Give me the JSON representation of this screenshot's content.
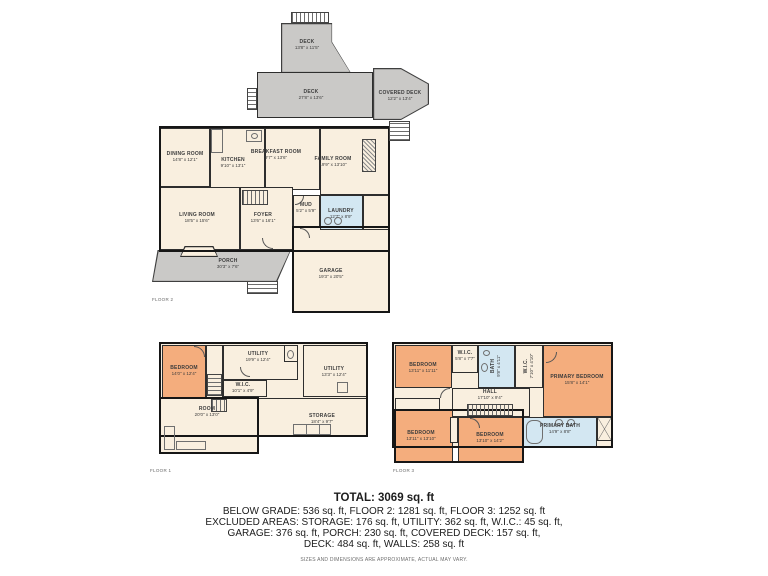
{
  "colors": {
    "room_cream": "#f9efdf",
    "bedroom_orange": "#f4ad7d",
    "bath_blue": "#d3e7f2",
    "deck_gray": "#cac9c7",
    "wall": "#161616"
  },
  "floor2": {
    "label": "FLOOR 2",
    "rooms": {
      "deck_upper": {
        "name": "DECK",
        "dims": "13'8\" x 11'5\""
      },
      "deck_main": {
        "name": "DECK",
        "dims": "27'8\" x 13'6\""
      },
      "covered_deck": {
        "name": "COVERED DECK",
        "dims": "12'2\" x 13'4\""
      },
      "dining": {
        "name": "DINING ROOM",
        "dims": "14'8\" x 12'1\""
      },
      "kitchen": {
        "name": "KITCHEN",
        "dims": "9'10\" x 13'1\""
      },
      "breakfast": {
        "name": "BREAKFAST ROOM",
        "dims": "9'7\" x 13'6\""
      },
      "family": {
        "name": "FAMILY ROOM",
        "dims": "19'9\" x 13'10\""
      },
      "living": {
        "name": "LIVING ROOM",
        "dims": "18'5\" x 15'6\""
      },
      "foyer": {
        "name": "FOYER",
        "dims": "13'6\" x 16'1\""
      },
      "mud": {
        "name": "MUD",
        "dims": "5'2\" x 5'9\""
      },
      "laundry": {
        "name": "LAUNDRY",
        "dims": "12'7\" x 8'9\""
      },
      "porch": {
        "name": "PORCH",
        "dims": "30'3\" x 7'6\""
      },
      "garage": {
        "name": "GARAGE",
        "dims": "19'3\" x 20'5\""
      }
    }
  },
  "floor1": {
    "label": "FLOOR 1",
    "rooms": {
      "bedroom": {
        "name": "BEDROOM",
        "dims": "14'0\" x 12'4\""
      },
      "utility_top": {
        "name": "UTILITY",
        "dims": "19'9\" x 12'4\""
      },
      "utility_right": {
        "name": "UTILITY",
        "dims": "13'3\" x 12'4\""
      },
      "wic": {
        "name": "W.I.C.",
        "dims": "10'1\" x 4'9\""
      },
      "room": {
        "name": "ROOM",
        "dims": "20'0\" x 13'0\""
      },
      "storage": {
        "name": "STORAGE",
        "dims": "18'4\" x 9'7\""
      }
    }
  },
  "floor3": {
    "label": "FLOOR 3",
    "rooms": {
      "bedroom_tl": {
        "name": "BEDROOM",
        "dims": "13'11\" x 11'11\""
      },
      "wic_small": {
        "name": "W.I.C.",
        "dims": "5'8\" x 7'7\""
      },
      "bath": {
        "name": "BATH",
        "dims": "9'8\" x 4'11\""
      },
      "wic_primary": {
        "name": "W.I.C.",
        "dims": "7'10\" x 4'10\""
      },
      "primary_bedroom": {
        "name": "PRIMARY BEDROOM",
        "dims": "15'8\" x 14'1\""
      },
      "hall": {
        "name": "HALL",
        "dims": "17'10\" x 9'4\""
      },
      "bedroom_bl": {
        "name": "BEDROOM",
        "dims": "13'11\" x 13'10\""
      },
      "bedroom_bm": {
        "name": "BEDROOM",
        "dims": "13'10\" x 14'2\""
      },
      "primary_bath": {
        "name": "PRIMARY BATH",
        "dims": "14'9\" x 8'8\""
      }
    }
  },
  "footer": {
    "total": "TOTAL: 3069 sq. ft",
    "line1": "BELOW GRADE: 536 sq. ft, FLOOR 2: 1281 sq. ft, FLOOR 3: 1252 sq. ft",
    "line2": "EXCLUDED AREAS: STORAGE: 176 sq. ft, UTILITY: 362 sq. ft, W.I.C.: 45 sq. ft,",
    "line3": "GARAGE: 376 sq. ft, PORCH: 230 sq. ft, COVERED DECK: 157 sq. ft,",
    "line4": "DECK: 484 sq. ft, WALLS: 258 sq. ft",
    "disclaimer": "SIZES AND DIMENSIONS ARE APPROXIMATE, ACTUAL MAY VARY."
  }
}
